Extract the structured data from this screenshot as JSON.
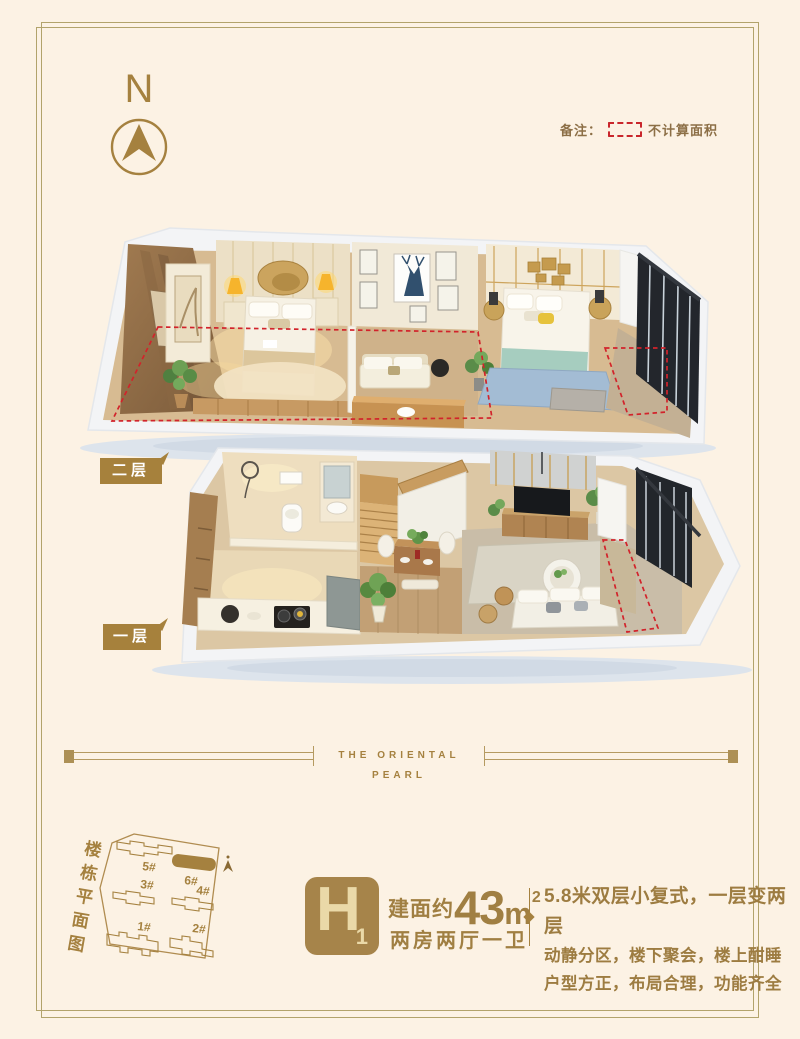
{
  "colors": {
    "background": "#fcf2e4",
    "frame": "#b2a36b",
    "gold": "#a5813f",
    "text_brown": "#8c6f46",
    "red_dashed": "#c9262c",
    "badge_bg": "#a6844a",
    "badge_text": "#ead9a8",
    "floor_tag_bg": "#a6813c"
  },
  "header": {
    "compass_letter": "N",
    "note_label": "备注：",
    "note_text": "不计算面积"
  },
  "plans": {
    "upper_tag": "二层",
    "lower_tag": "一层"
  },
  "divider": {
    "title": "THE ORIENTAL PEARL"
  },
  "site_plan": {
    "vertical_title": "楼栋平面图",
    "buildings": [
      {
        "label": "5#"
      },
      {
        "label": "6#"
      },
      {
        "label": "3#"
      },
      {
        "label": "4#"
      },
      {
        "label": "1#"
      },
      {
        "label": "2#"
      }
    ],
    "highlighted_building": "6#"
  },
  "unit": {
    "badge_letter": "H",
    "badge_sub": "1",
    "area_prefix": "建面约",
    "area_value": "43",
    "area_unit": "m",
    "area_sup": "2",
    "layout": "两房两厅一卫"
  },
  "description": {
    "line1": "5.8米双层小复式，一层变两层",
    "line2": "动静分区，楼下聚会，楼上酣睡",
    "line3": "户型方正，布局合理，功能齐全"
  }
}
